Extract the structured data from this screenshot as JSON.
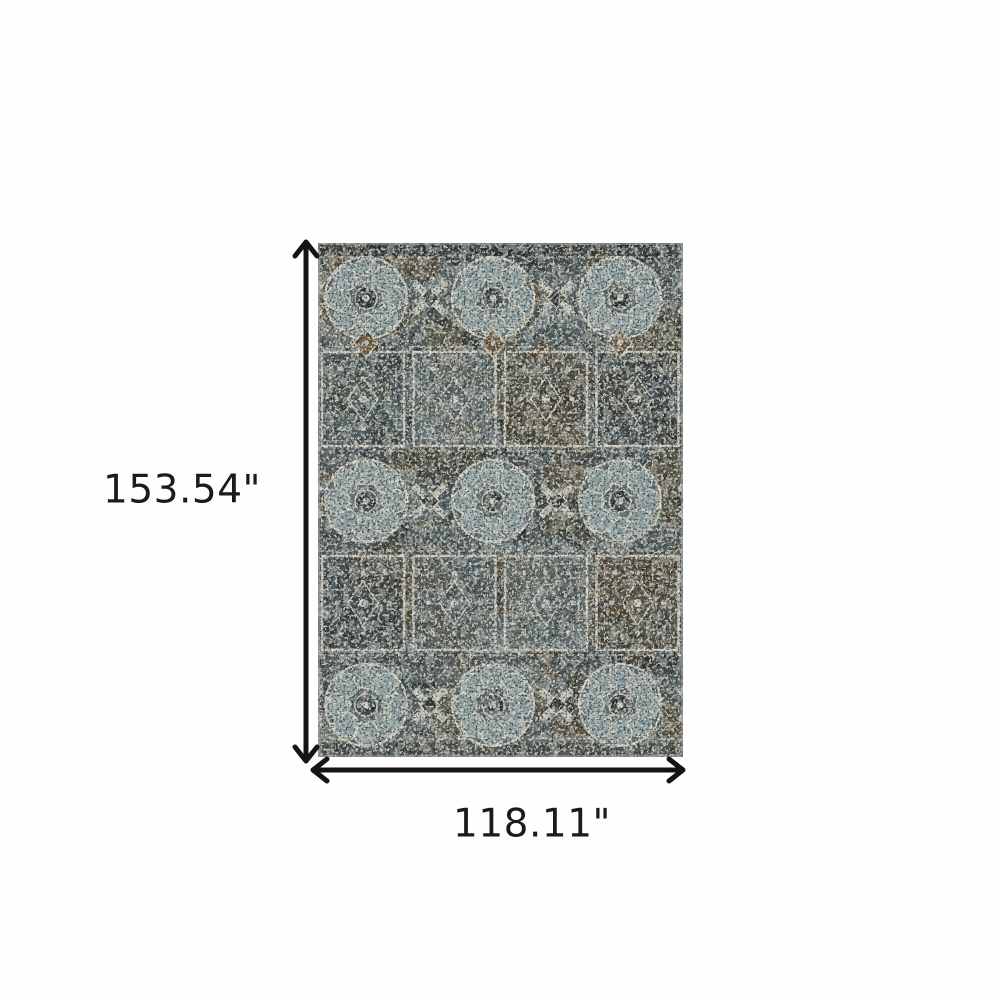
{
  "diagram": {
    "height_label": "153.54\"",
    "width_label": "118.11\"",
    "height_inches": 153.54,
    "width_inches": 118.11,
    "unit": "inches"
  },
  "product": {
    "kind": "area-rug",
    "style": "distressed-oriental-medallion",
    "palette": {
      "base_slate": "#4d585b",
      "charcoal": "#242a2c",
      "slate_blue": "#5a6c72",
      "light_blue_gray": "#8da0a4",
      "cream": "#d7d3c4",
      "brown": "#5d4728"
    }
  },
  "colors": {
    "background": "#fefefe",
    "arrow": "#141414",
    "label_text": "#1b1b1b"
  }
}
